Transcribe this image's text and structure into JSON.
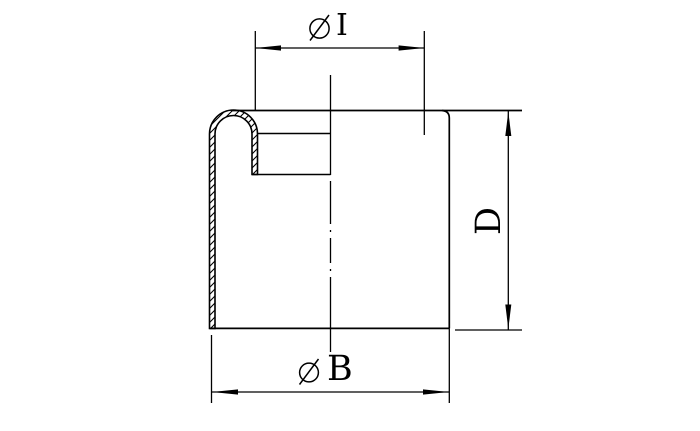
{
  "page": {
    "background_color": "#ffffff",
    "line_color": "#000000"
  },
  "drawing": {
    "kind": "end-cap cross-section with rolled rim",
    "dimensions": {
      "inner_diameter": {
        "icon": "diameter-icon",
        "letter": "I"
      },
      "outer_diameter": {
        "icon": "diameter-icon",
        "letter": "B"
      },
      "height": {
        "letter": "D"
      }
    }
  }
}
